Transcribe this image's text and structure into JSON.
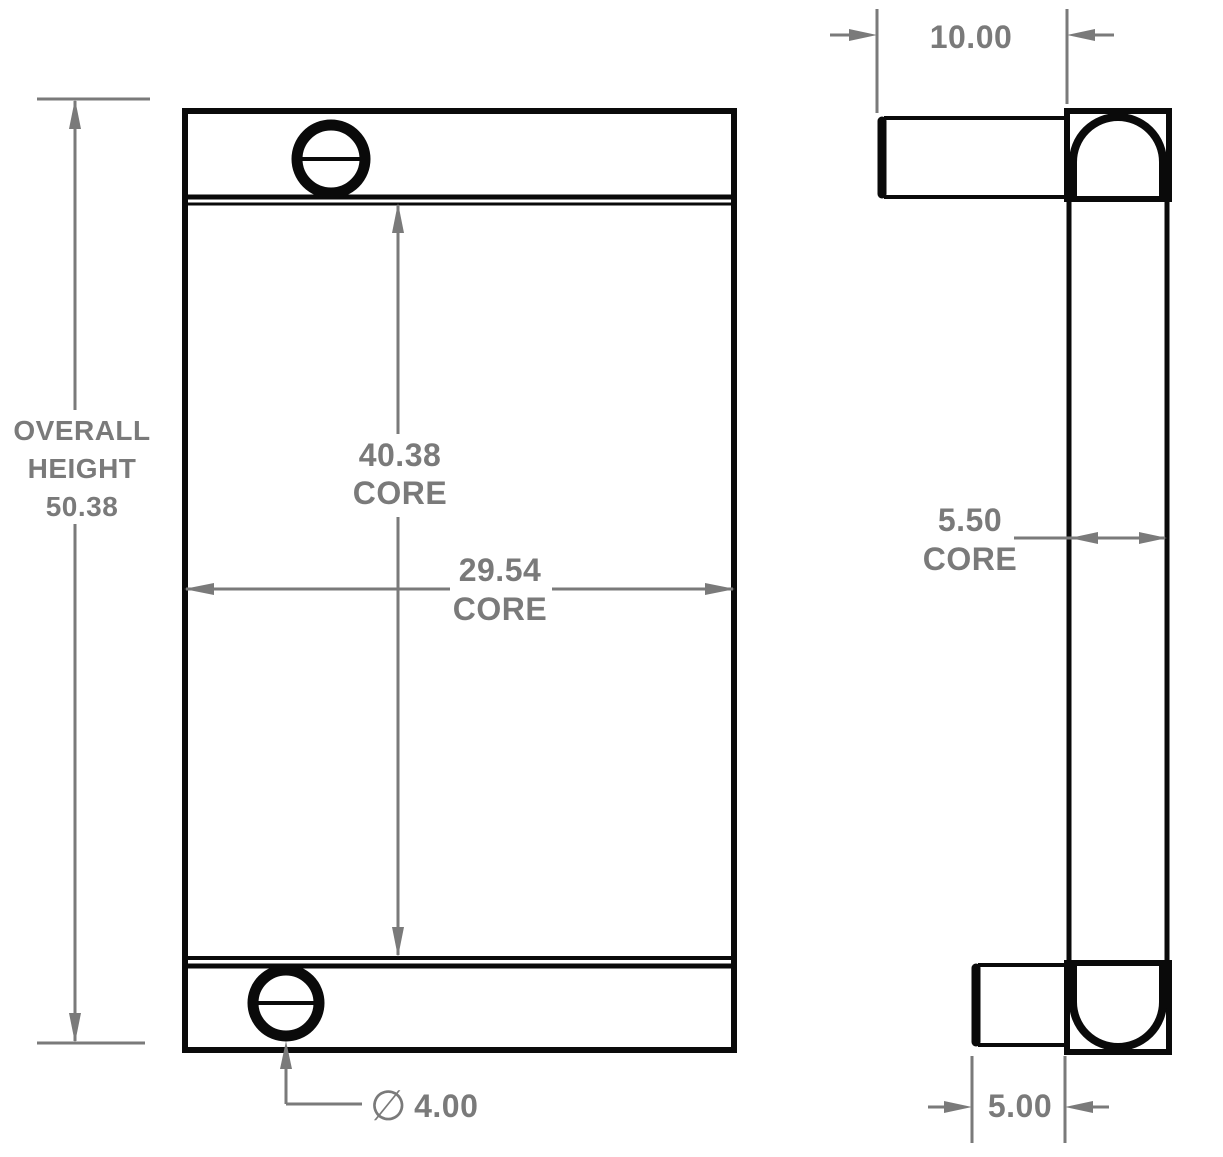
{
  "drawing": {
    "colors": {
      "outline": "#0a0a0a",
      "dimension": "#7a7a7a",
      "background": "#ffffff"
    },
    "labels": {
      "overall_height": {
        "line1": "OVERALL",
        "line2": "HEIGHT",
        "line3": "50.38"
      },
      "core_height": {
        "value": "40.38",
        "unit_label": "CORE"
      },
      "core_width": {
        "value": "29.54",
        "unit_label": "CORE"
      },
      "overall_depth": {
        "value": "10.00"
      },
      "core_depth": {
        "value": "5.50",
        "unit_label": "CORE"
      },
      "bottom_inlet_depth": {
        "value": "5.00"
      },
      "port_diameter": {
        "symbol": "∅",
        "value": "4.00"
      }
    }
  }
}
